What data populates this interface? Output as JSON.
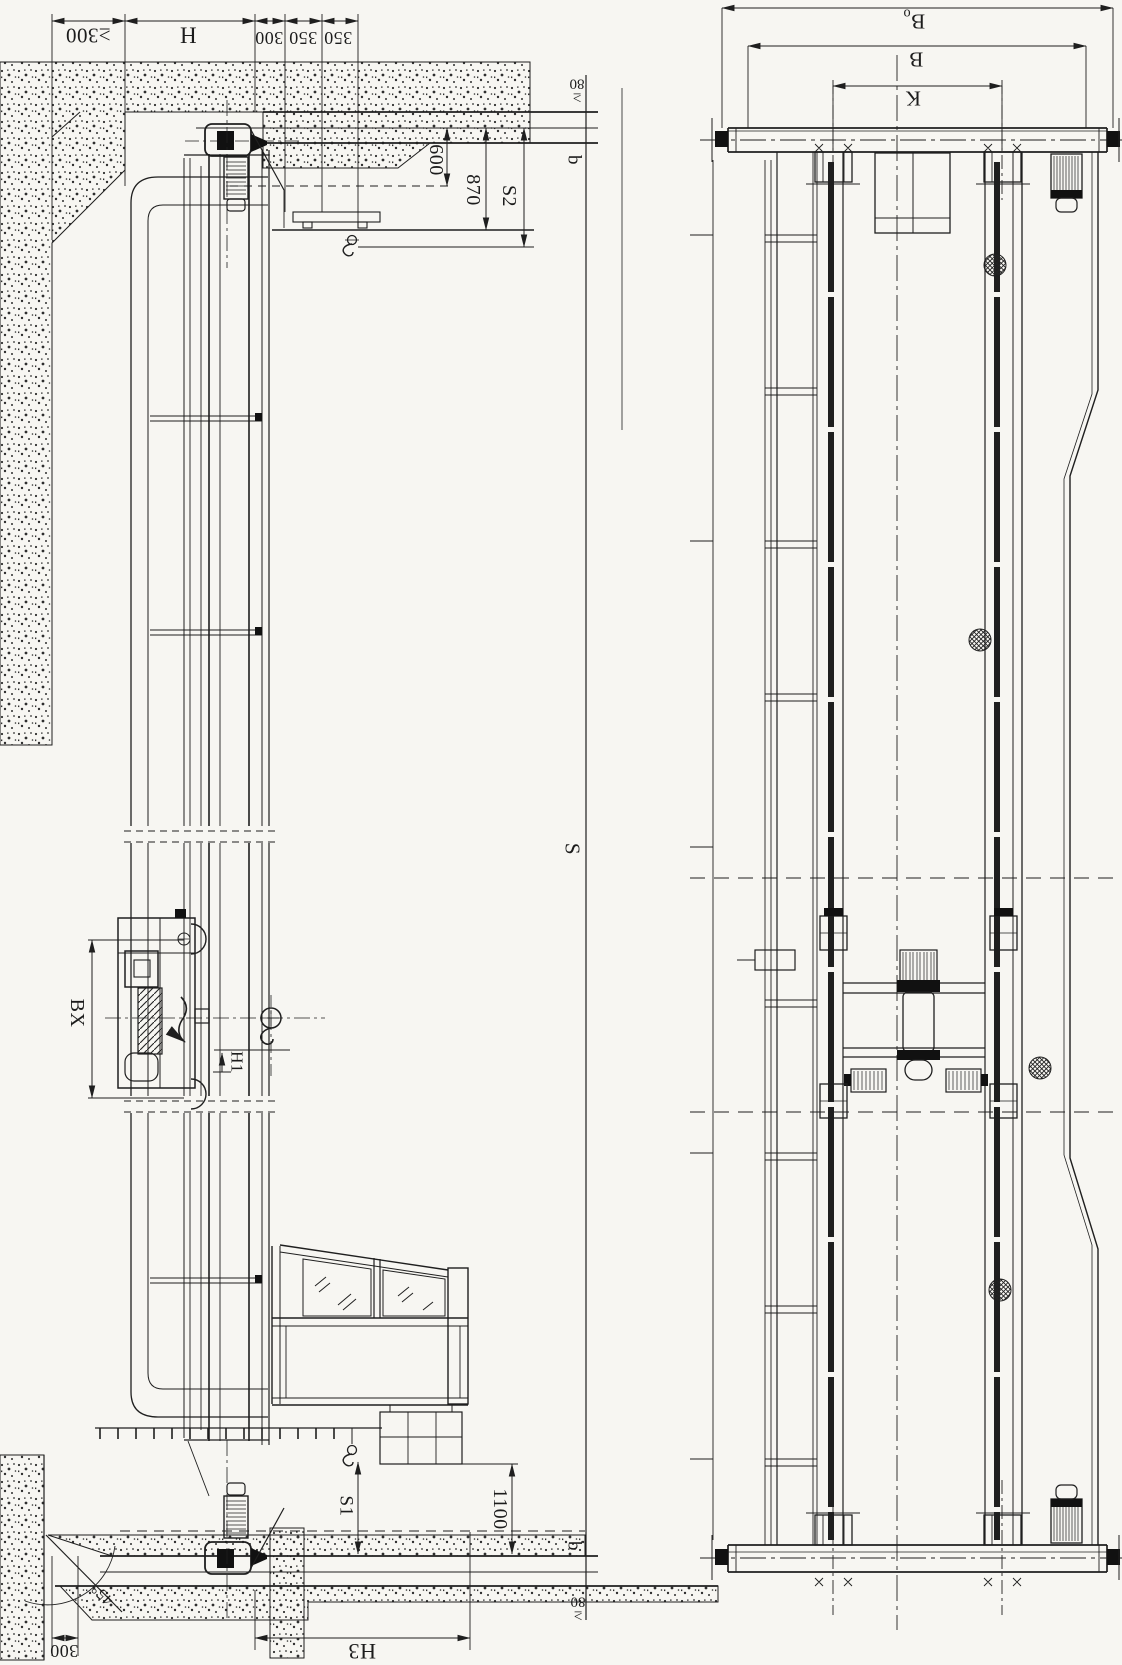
{
  "drawing_colors": {
    "ink": "#1c1c1c",
    "paper": "#f7f6f2"
  },
  "elevation_view": {
    "top_dims": [
      "≥300",
      "H",
      "300",
      "350",
      "350"
    ],
    "runway_dims": [
      "600",
      "870",
      "S2"
    ],
    "clearance_top": {
      "prefix": "≥",
      "value": "80"
    },
    "rail_gap_top": "b",
    "span": "S",
    "trolley_width": "BX",
    "hook_travel": "H1",
    "hook_approach": "S1",
    "cab_clearance": "1100",
    "rail_gap_bottom": "b",
    "clearance_bottom": {
      "prefix": "≥",
      "value": "80"
    },
    "wall_offset": "300",
    "chamfer_angle": "45°",
    "cab_height": "H3"
  },
  "plan_view": {
    "overall_width": {
      "main": "B",
      "sub": "o"
    },
    "girder_spacing": "B",
    "wheel_base": "K"
  }
}
